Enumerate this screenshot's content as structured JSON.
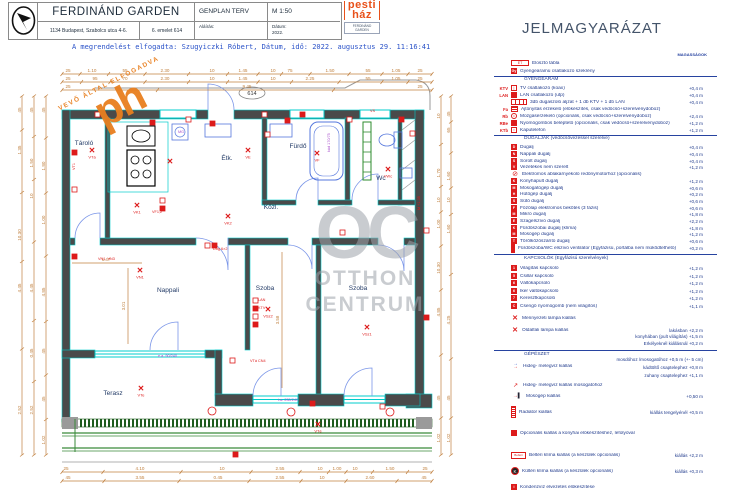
{
  "colors": {
    "red": "#dd1b1b",
    "navy": "#1f3a8c",
    "dim": "#c0803f",
    "wall": "#4a4a4a",
    "cyan": "#00cccc",
    "green": "#2e8b2e",
    "purple": "#a64ccc",
    "orange": "#e87f1f",
    "watermark": "#9ea3ab"
  },
  "title_block": {
    "project": "FERDINÁND GARDEN",
    "address": "1134 Budapest, Szabolcs utca 4-6.",
    "unit": "6. emelet 614",
    "drawing": "GENPLAN TERV",
    "scale": "M 1:50",
    "signature_label": "Aláírás:",
    "date_label": "Dátum:",
    "date_value": "2022."
  },
  "ph_logo": {
    "line1": "pesti",
    "line2": "ház",
    "caption": "FERDINÁND",
    "caption2": "GARDEN"
  },
  "approval_line": "A megrendelést elfogadta: Szugyiczki Róbert, Dátum, idő: 2022. augusztus 29. 11:16:41",
  "stamp": {
    "text": "VEVŐ ÁLTAL ELFOGADVA",
    "big": "ph"
  },
  "watermark": {
    "big": "OC",
    "line1": "OTTHON",
    "line2": "CENTRUM"
  },
  "plan": {
    "unit_number": "614",
    "rooms": [
      {
        "x": 84,
        "y": 145,
        "t": "Tároló"
      },
      {
        "x": 227,
        "y": 160,
        "t": "Étk."
      },
      {
        "x": 298,
        "y": 148,
        "t": "Fürdő"
      },
      {
        "x": 381,
        "y": 180,
        "t": "Wc"
      },
      {
        "x": 271,
        "y": 209,
        "t": "Közl."
      },
      {
        "x": 168,
        "y": 292,
        "t": "Nappali"
      },
      {
        "x": 265,
        "y": 290,
        "t": "Szoba"
      },
      {
        "x": 358,
        "y": 290,
        "t": "Szoba"
      },
      {
        "x": 113,
        "y": 395,
        "t": "Terasz"
      }
    ],
    "dims_h": [
      {
        "y": 72,
        "labels": [
          [
            68,
            "25"
          ],
          [
            92,
            "1.10"
          ],
          [
            125,
            "55"
          ],
          [
            165,
            "2.30"
          ],
          [
            212,
            "10"
          ],
          [
            243,
            "1.45"
          ],
          [
            273,
            "10"
          ],
          [
            290,
            "75"
          ],
          [
            330,
            "1.50"
          ],
          [
            368,
            "55"
          ],
          [
            396,
            "1.05"
          ],
          [
            420,
            "25"
          ]
        ]
      },
      {
        "y": 80,
        "labels": [
          [
            68,
            "25"
          ],
          [
            95,
            "95"
          ],
          [
            125,
            "70"
          ],
          [
            165,
            "2.30"
          ],
          [
            212,
            "10"
          ],
          [
            243,
            "1.45"
          ],
          [
            273,
            "10"
          ],
          [
            310,
            "2.25"
          ],
          [
            368,
            "55"
          ],
          [
            396,
            "1.05"
          ],
          [
            420,
            "25"
          ]
        ]
      },
      {
        "y": 88,
        "labels": [
          [
            68,
            "25"
          ],
          [
            247,
            "9.45"
          ],
          [
            420,
            "25"
          ]
        ]
      },
      {
        "y": 470,
        "labels": [
          [
            66,
            "25"
          ],
          [
            140,
            "4.10"
          ],
          [
            222,
            "10"
          ],
          [
            280,
            "2.55"
          ],
          [
            320,
            "10"
          ],
          [
            337,
            "1.00"
          ],
          [
            355,
            "10"
          ],
          [
            390,
            "1.50"
          ],
          [
            425,
            "25"
          ]
        ]
      },
      {
        "y": 479,
        "labels": [
          [
            68,
            "45"
          ],
          [
            140,
            "3.55"
          ],
          [
            218,
            "0.45"
          ],
          [
            280,
            "2.55"
          ],
          [
            322,
            "10"
          ],
          [
            370,
            "2.60"
          ],
          [
            424,
            "45"
          ]
        ]
      }
    ],
    "dims_v": [
      {
        "x": 20,
        "labels": [
          [
            110,
            "45"
          ],
          [
            150,
            "1.35"
          ],
          [
            235,
            "10.30"
          ],
          [
            288,
            "4.45"
          ],
          [
            410,
            "2.52"
          ]
        ]
      },
      {
        "x": 32,
        "labels": [
          [
            110,
            "45"
          ],
          [
            163,
            "1.50"
          ],
          [
            196,
            "10"
          ],
          [
            288,
            "4.45"
          ],
          [
            353,
            "0.45"
          ],
          [
            410,
            "2.52"
          ]
        ]
      },
      {
        "x": 44,
        "labels": [
          [
            110,
            "45"
          ],
          [
            166,
            "1.80"
          ],
          [
            220,
            "1.00"
          ],
          [
            292,
            "4.85"
          ],
          [
            351,
            "45"
          ],
          [
            399,
            "45"
          ],
          [
            440,
            "1.02"
          ]
        ]
      },
      {
        "x": 439,
        "labels": [
          [
            116,
            "10"
          ],
          [
            173,
            "1.70"
          ],
          [
            200,
            "10"
          ],
          [
            224,
            "1.00"
          ],
          [
            268,
            "10.30"
          ],
          [
            312,
            "4.85"
          ],
          [
            398,
            "45"
          ],
          [
            438,
            "1.02"
          ]
        ]
      },
      {
        "x": 449,
        "labels": [
          [
            114,
            "45"
          ],
          [
            130,
            "65"
          ],
          [
            176,
            "1.60"
          ],
          [
            200,
            "10"
          ],
          [
            229,
            "1.60"
          ],
          [
            320,
            "4.25"
          ],
          [
            398,
            "45"
          ],
          [
            438,
            "1.02"
          ]
        ]
      }
    ],
    "interior_dims": [
      {
        "x": 106,
        "y": 261,
        "t": "1.47",
        "rot": 0
      },
      {
        "x": 125,
        "y": 306,
        "t": "3.01",
        "rot": 1
      },
      {
        "x": 279,
        "y": 320,
        "t": "3.58",
        "rot": 1
      }
    ],
    "symbols": [
      [
        92,
        153,
        "VTá"
      ],
      [
        137,
        208,
        "VK1"
      ],
      [
        170,
        164,
        ""
      ],
      [
        248,
        153,
        "VE"
      ],
      [
        317,
        156,
        "VF"
      ],
      [
        388,
        172,
        "VWc"
      ],
      [
        140,
        273,
        "VN1"
      ],
      [
        268,
        312,
        "VSz2"
      ],
      [
        367,
        330,
        "VSz1"
      ],
      [
        141,
        391,
        "VTe"
      ],
      [
        318,
        427,
        "VTé"
      ],
      [
        228,
        219,
        "VK2"
      ]
    ],
    "boxes": [
      [
        95,
        112
      ],
      [
        150,
        120
      ],
      [
        186,
        117
      ],
      [
        210,
        121
      ],
      [
        262,
        112
      ],
      [
        300,
        112
      ],
      [
        347,
        117
      ],
      [
        399,
        117
      ],
      [
        410,
        131
      ],
      [
        72,
        150
      ],
      [
        72,
        187
      ],
      [
        72,
        254
      ],
      [
        253,
        298
      ],
      [
        253,
        306
      ],
      [
        253,
        314
      ],
      [
        253,
        322
      ],
      [
        205,
        243
      ],
      [
        212,
        243
      ],
      [
        160,
        198
      ],
      [
        160,
        206
      ],
      [
        424,
        228
      ],
      [
        424,
        315
      ],
      [
        230,
        358
      ],
      [
        310,
        401
      ],
      [
        380,
        404
      ],
      [
        233,
        452
      ],
      [
        265,
        132
      ],
      [
        285,
        118
      ],
      [
        340,
        230
      ]
    ],
    "circles": [
      [
        212,
        411
      ],
      [
        291,
        412
      ],
      [
        390,
        412
      ]
    ],
    "red_labels": [
      [
        258,
        301,
        "LAN",
        0
      ],
      [
        258,
        309,
        "KTV",
        0
      ],
      [
        213,
        250,
        "Dug 6×2",
        0
      ],
      [
        152,
        213,
        "VF1,2",
        0
      ],
      [
        98,
        260,
        "VN1, VN3",
        0
      ],
      [
        420,
        210,
        "M +1,35",
        1
      ],
      [
        75,
        170,
        "VT1",
        1
      ],
      [
        250,
        362,
        "VTá CN4",
        0
      ],
      [
        370,
        112,
        "VS",
        0
      ]
    ],
    "purple_labels": [
      [
        178,
        133,
        "MG",
        0
      ],
      [
        330,
        152,
        "kád 170/75",
        1
      ],
      [
        158,
        357,
        "e.a. 90/240",
        0
      ],
      [
        278,
        401,
        "t.a. 230/240",
        0
      ]
    ]
  },
  "legend": {
    "title": "JELMAGYARÁZAT",
    "heights_header": "MAGASSÁGOK",
    "headers": [
      {
        "y": 80,
        "t": "GYENGEÁRAM"
      },
      {
        "y": 139,
        "t": "DUGALJAK (védőcsövezéssel szerelve)"
      },
      {
        "y": 259,
        "t": "KAPCSOLÓK (Egyfázisú szerelvények)"
      },
      {
        "y": 355,
        "t": "GÉPÉSZET"
      }
    ],
    "dividers": [
      76,
      135,
      254,
      350
    ],
    "rows": [
      {
        "y": 63,
        "prefix": "",
        "icon": "wide",
        "glyph": "ET",
        "label": "Elosztó tábla",
        "h": ""
      },
      {
        "y": 71,
        "prefix": "",
        "icon": "fill",
        "glyph": "Gy",
        "label": "Gyengeáramú csatlakozó szekrény",
        "h": ""
      },
      {
        "y": 88,
        "prefix": "KTV",
        "icon": "box",
        "glyph": "|",
        "label": "TV csatlakozó (koax)",
        "h": "+0,4 m"
      },
      {
        "y": 95,
        "prefix": "LAN",
        "icon": "fill",
        "glyph": "",
        "label": "LAN csatlakozó (utp)",
        "h": "+0,4 m"
      },
      {
        "y": 102,
        "prefix": "",
        "icon": "triple",
        "glyph": "",
        "label": "3db dugaszoló aljzat + 1 db KTV + 1 db LAN",
        "h": "+0,4 m"
      },
      {
        "y": 109,
        "prefix": "Fa",
        "icon": "fa",
        "glyph": "",
        "label": "Ajtónyitás érzékelő (előkészítés, csak védőcső+szerelvénydoboz)",
        "h": ""
      },
      {
        "y": 116,
        "prefix": "Rb",
        "icon": "circ",
        "glyph": "•",
        "label": "Mozgásérzékelő (opcionális, csak védőcső+szerelvénydoboz)",
        "h": "+2,4 m"
      },
      {
        "y": 123,
        "prefix": "RBe",
        "icon": "fill",
        "glyph": "",
        "label": "Nyomógombos beléptető (opcionális, csak védőcső+szerelvénydoboz)",
        "h": "+1,2 m"
      },
      {
        "y": 130,
        "prefix": "KTb",
        "icon": "box",
        "glyph": "▪",
        "label": "Kaputelefon",
        "h": "+1,2 m"
      },
      {
        "y": 147,
        "prefix": "",
        "icon": "fill",
        "glyph": "D",
        "label": "Dugalj",
        "h": "+0,4 m"
      },
      {
        "y": 154,
        "prefix": "",
        "icon": "fill",
        "glyph": "N",
        "label": "Nappali dugalj",
        "h": "+0,4 m"
      },
      {
        "y": 161,
        "prefix": "",
        "icon": "fill",
        "glyph": "S",
        "label": "Sorolt dugalj",
        "h": "+0,4 m"
      },
      {
        "y": 167,
        "prefix": "",
        "icon": "fill",
        "glyph": "V",
        "label": "Vezetékes nem szerelt",
        "h": "+1,2 m"
      },
      {
        "y": 174,
        "prefix": "",
        "icon": "circslash",
        "glyph": "⊘",
        "label": "Elektromos ablakárnyékoló redőnymotorhoz (opcionális)",
        "h": ""
      },
      {
        "y": 181,
        "prefix": "",
        "icon": "fill",
        "glyph": "K",
        "label": "Konyhapult dugalj",
        "h": "+1,2 m"
      },
      {
        "y": 188,
        "prefix": "",
        "icon": "fill",
        "glyph": "M",
        "label": "Mosogatógép dugalj",
        "h": "+0,6 m"
      },
      {
        "y": 194,
        "prefix": "",
        "icon": "fill",
        "glyph": "H",
        "label": "Hűtőgép dugalj",
        "h": "+0,2 m"
      },
      {
        "y": 201,
        "prefix": "",
        "icon": "fill",
        "glyph": "S",
        "label": "Sütő dugalj",
        "h": "+0,6 m"
      },
      {
        "y": 208,
        "prefix": "",
        "icon": "fill",
        "glyph": "F",
        "label": "Főzőlap elektromos bekötés (3 fázis)",
        "h": "+0,6 m"
      },
      {
        "y": 214,
        "prefix": "",
        "icon": "fill",
        "glyph": "M",
        "label": "Mikró dugalj",
        "h": "+1,8 m"
      },
      {
        "y": 221,
        "prefix": "",
        "icon": "fill",
        "glyph": "E",
        "label": "Szagelszívó dugalj",
        "h": "+2,2 m"
      },
      {
        "y": 228,
        "prefix": "",
        "icon": "fill",
        "glyph": "K",
        "label": "Fürdőszobai dugalj (klíma)",
        "h": "+1,8 m"
      },
      {
        "y": 234,
        "prefix": "",
        "icon": "fill",
        "glyph": "M",
        "label": "Mosógép dugalj",
        "h": "+1,2 m"
      },
      {
        "y": 241,
        "prefix": "",
        "icon": "fill",
        "glyph": "T",
        "label": "Törölközőszárító dugalj",
        "h": "+0,6 m"
      },
      {
        "y": 248,
        "prefix": "",
        "icon": "tall",
        "glyph": "",
        "label": "Fürdőszoba/WC elszívó ventilátor (Egyfázisú, portálba nem működtethető)",
        "h": "+0,2 m"
      },
      {
        "y": 268,
        "prefix": "",
        "icon": "fill",
        "glyph": "1",
        "label": "Világítás kapcsoló",
        "h": "+1,2 m"
      },
      {
        "y": 276,
        "prefix": "",
        "icon": "fill",
        "glyph": "5",
        "label": "Csillár kapcsoló",
        "h": "+1,2 m"
      },
      {
        "y": 283,
        "prefix": "",
        "icon": "fill",
        "glyph": "6",
        "label": "Váltókapcsoló",
        "h": "+1,2 m"
      },
      {
        "y": 291,
        "prefix": "",
        "icon": "fill",
        "glyph": "6",
        "label": "Iker váltókapcsoló",
        "h": "+1,2 m"
      },
      {
        "y": 298,
        "prefix": "",
        "icon": "fill",
        "glyph": "7",
        "label": "Keresztkapcsoló",
        "h": "+1,2 m"
      },
      {
        "y": 306,
        "prefix": "",
        "icon": "fill",
        "glyph": "C",
        "label": "Csengő nyomógomb (nem világítós)",
        "h": "+1,1 m"
      },
      {
        "y": 318,
        "prefix": "",
        "icon": "x",
        "glyph": "✕",
        "label": "Mennyezeti lámpa kiállás",
        "h": ""
      },
      {
        "y": 330,
        "prefix": "",
        "icon": "x",
        "glyph": "✕",
        "label": "Oldalfali lámpa kiállás",
        "h": "lakásban +2,2 m"
      },
      {
        "y": 366,
        "prefix": "",
        "icon": "hmv",
        "glyph": "",
        "label": "Hideg- melegvíz kiállás",
        "h": ""
      },
      {
        "y": 385,
        "prefix": "",
        "icon": "hmv2",
        "glyph": "↗",
        "label": "Hideg- melegvíz kiállás mosogatóhoz",
        "h": ""
      },
      {
        "y": 396,
        "prefix": "",
        "icon": "mk",
        "glyph": "→▌",
        "label": "Mosógép kiállás",
        "h": "+0,50 m"
      },
      {
        "y": 412,
        "prefix": "",
        "icon": "rad",
        "glyph": "",
        "label": "Radiátor kiállás",
        "h": "kiállás tengelyénél +0,5 m"
      },
      {
        "y": 433,
        "prefix": "",
        "icon": "fill",
        "glyph": "",
        "label": "Opcionális kiállás a konyhai előkészítéshez, lefolyóval",
        "h": ""
      },
      {
        "y": 455,
        "prefix": "",
        "icon": "belt",
        "glyph": "Beltéri",
        "label": "Beltéri klíma kiállás (a készülék opcionális)",
        "h": "kiállás +2,2 m"
      },
      {
        "y": 471,
        "prefix": "",
        "icon": "kult",
        "glyph": "K",
        "label": "Kültéri klíma kiállás (a készülék opcionális)",
        "h": "kiállás +0,3 m"
      },
      {
        "y": 487,
        "prefix": "",
        "icon": "fill",
        "glyph": "i",
        "label": "Kondenzvíz elvezetés előkészítése",
        "h": ""
      }
    ],
    "notes": [
      {
        "y": 337,
        "t": "konyhában (pult világítás) +1,5 m"
      },
      {
        "y": 344,
        "t": "Erkélyeknél kiállásnál +0,2 m"
      },
      {
        "y": 360,
        "t": "mosdóhoz /mosogatóhoz +0,5 m (+- 5 cm)"
      },
      {
        "y": 368,
        "t": "kádtöltő csaptelephez +0,8 m"
      },
      {
        "y": 376,
        "t": "zuhany csaptelephez +1,1 m"
      }
    ]
  }
}
